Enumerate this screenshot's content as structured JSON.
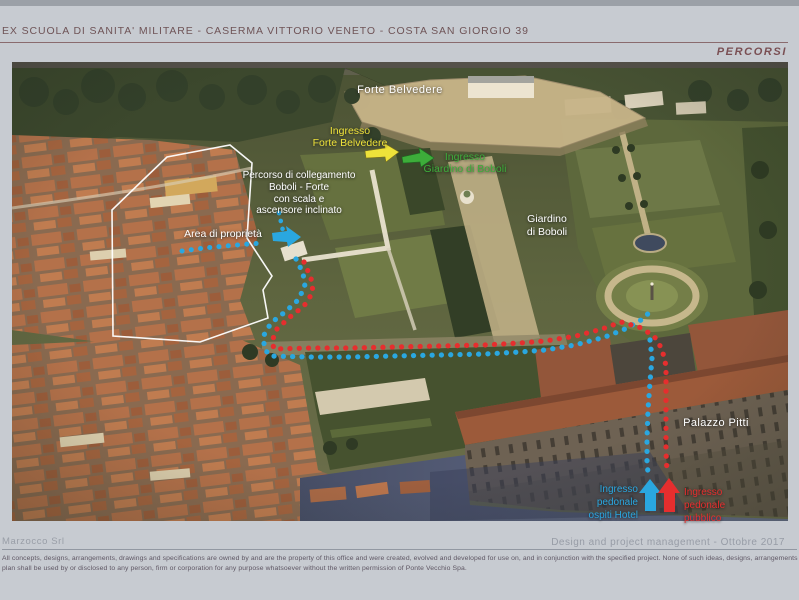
{
  "header": {
    "title": "EX SCUOLA DI SANITA' MILITARE - CASERMA VITTORIO VENETO - COSTA SAN GIORGIO 39",
    "section_label": "PERCORSI"
  },
  "footer": {
    "company": "Marzocco Srl",
    "credit": "Design and project management - Ottobre 2017",
    "disclaimer_line1": "All concepts, designs, arrangements, drawings and specifications are owned by and are the property of this office and were created, evolved and developed for use on, and in conjunction with the specified project. None of such ideas, designs, arrangements or",
    "disclaimer_line2": "plan shall be used by or disclosed to any person, firm or corporation for any purpose whatsoever without the written permission of Ponte Vecchio Spa."
  },
  "map": {
    "labels": {
      "forte_belvedere": "Forte Belvedere",
      "ingresso_forte": [
        "Ingresso",
        "Forte Belvedere"
      ],
      "ingresso_giardino": [
        "Ingresso",
        "Giardino di Boboli"
      ],
      "percorso_collegamento": [
        "Percorso di collegamento",
        "Boboli - Forte",
        "con scala e",
        "ascensore inclinato"
      ],
      "area_di_proprieta": "Area di proprietà",
      "giardino_di_boboli": [
        "Giardino",
        "di Boboli"
      ],
      "palazzo_pitti": "Palazzo Pitti",
      "ingresso_hotel": [
        "Ingresso",
        "pedonale",
        "ospiti Hotel"
      ],
      "ingresso_pubblico": [
        "Ingresso",
        "pedonale",
        "pubblico"
      ]
    },
    "colors": {
      "hotel_route": "#2aa7e0",
      "public_route": "#e62e2e",
      "forte_entrance_arrow": "#eee23a",
      "giardino_entrance_arrow": "#3dad3a",
      "property_boundary": "#ffffff"
    }
  }
}
